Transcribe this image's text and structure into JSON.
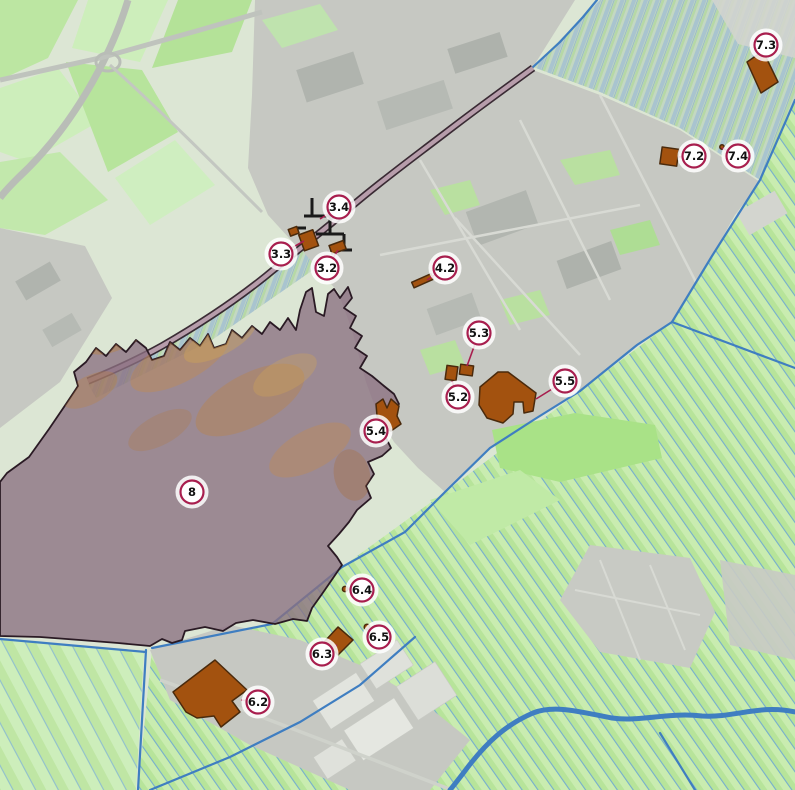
{
  "map": {
    "kind": "aerial planning map with numbered heritage object markers",
    "marker_style": {
      "fill": "#ffffff",
      "stroke": "#a81e4e",
      "text_color": "#111111",
      "radius": 11.5
    },
    "object_style": {
      "fill": "#a3520f",
      "stroke": "#4a2a0c"
    },
    "zone_style": {
      "fill": "rgba(139,111,128,0.78)",
      "outline": "#2a1a24"
    },
    "dike_style": {
      "fill": "#b79dab",
      "outline": "#2d1c27"
    },
    "water_color": "#3f7ec1",
    "markers": [
      {
        "id": "3.2",
        "label": "3.2",
        "x": 327,
        "y": 268,
        "leader": {
          "x": 338,
          "y": 250
        }
      },
      {
        "id": "3.3",
        "label": "3.3",
        "x": 281,
        "y": 254,
        "leader": {
          "x": 304,
          "y": 241
        }
      },
      {
        "id": "3.4",
        "label": "3.4",
        "x": 339,
        "y": 207,
        "leader": {
          "x": 320,
          "y": 219
        }
      },
      {
        "id": "4.2",
        "label": "4.2",
        "x": 445,
        "y": 268,
        "leader": {
          "x": 427,
          "y": 280
        }
      },
      {
        "id": "5.2",
        "label": "5.2",
        "x": 458,
        "y": 397,
        "leader": {
          "x": 452,
          "y": 381
        }
      },
      {
        "id": "5.3",
        "label": "5.3",
        "x": 479,
        "y": 333,
        "leader": {
          "x": 467,
          "y": 366
        }
      },
      {
        "id": "5.4",
        "label": "5.4",
        "x": 376,
        "y": 431,
        "leader": {
          "x": 387,
          "y": 422
        }
      },
      {
        "id": "5.5",
        "label": "5.5",
        "x": 565,
        "y": 381,
        "leader": {
          "x": 536,
          "y": 399
        }
      },
      {
        "id": "6.2",
        "label": "6.2",
        "x": 258,
        "y": 702,
        "leader": {
          "x": 241,
          "y": 700
        }
      },
      {
        "id": "6.3",
        "label": "6.3",
        "x": 322,
        "y": 654,
        "leader": {
          "x": 337,
          "y": 645
        }
      },
      {
        "id": "6.4",
        "label": "6.4",
        "x": 362,
        "y": 590,
        "leader": {
          "x": 348,
          "y": 589
        }
      },
      {
        "id": "6.5",
        "label": "6.5",
        "x": 379,
        "y": 637,
        "leader": {
          "x": 368,
          "y": 628
        }
      },
      {
        "id": "7.2",
        "label": "7.2",
        "x": 694,
        "y": 156,
        "leader": {
          "x": 678,
          "y": 157
        }
      },
      {
        "id": "7.3",
        "label": "7.3",
        "x": 766,
        "y": 45,
        "leader": {
          "x": 760,
          "y": 61
        }
      },
      {
        "id": "7.4",
        "label": "7.4",
        "x": 738,
        "y": 156,
        "leader": {
          "x": 722,
          "y": 148
        }
      },
      {
        "id": "8",
        "label": "8",
        "x": 192,
        "y": 492,
        "leader": null
      }
    ]
  }
}
